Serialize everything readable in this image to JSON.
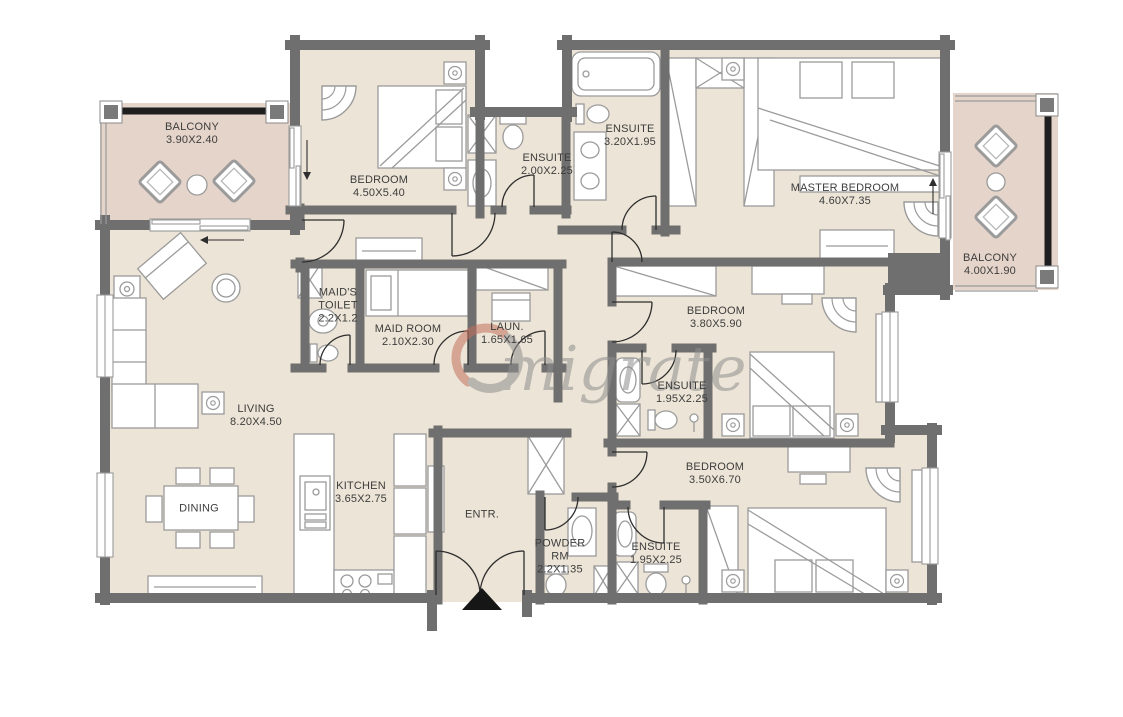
{
  "watermark": {
    "text": "migrate"
  },
  "colors": {
    "wall": "#6f6f6f",
    "floor": "#ece4d6",
    "balcony_floor": "#e5d4c9",
    "line": "#2e2e2e",
    "logo_accent": "#c4705c",
    "label_text": "#3d3d3d"
  },
  "rooms": [
    {
      "id": "balcony-left",
      "name": "BALCONY",
      "dims": "3.90X2.40"
    },
    {
      "id": "bedroom-1",
      "name": "BEDROOM",
      "dims": "4.50X5.40"
    },
    {
      "id": "ensuite-bedroom-1",
      "name": "ENSUITE",
      "dims": "2.00X2.25"
    },
    {
      "id": "ensuite-master",
      "name": "ENSUITE",
      "dims": "3.20X1.95"
    },
    {
      "id": "master-bedroom",
      "name": "MASTER BEDROOM",
      "dims": "4.60X7.35"
    },
    {
      "id": "balcony-right",
      "name": "BALCONY",
      "dims": "4.00X1.90"
    },
    {
      "id": "maids-toilet",
      "name": "MAID'S TOILET",
      "dims": "2.2X1.2"
    },
    {
      "id": "maid-room",
      "name": "MAID ROOM",
      "dims": "2.10X2.30"
    },
    {
      "id": "laundry",
      "name": "LAUN.",
      "dims": "1.65X1.65"
    },
    {
      "id": "bedroom-2",
      "name": "BEDROOM",
      "dims": "3.80X5.90"
    },
    {
      "id": "ensuite-bedroom-2",
      "name": "ENSUITE",
      "dims": "1.95X2.25"
    },
    {
      "id": "living",
      "name": "LIVING",
      "dims": "8.20X4.50"
    },
    {
      "id": "dining",
      "name": "DINING",
      "dims": ""
    },
    {
      "id": "kitchen",
      "name": "KITCHEN",
      "dims": "3.65X2.75"
    },
    {
      "id": "entrance",
      "name": "ENTR.",
      "dims": ""
    },
    {
      "id": "powder-room",
      "name": "POWDER RM",
      "dims": "2.2X1.35"
    },
    {
      "id": "ensuite-bedroom-3",
      "name": "ENSUITE",
      "dims": "1.95X2.25"
    },
    {
      "id": "bedroom-3",
      "name": "BEDROOM",
      "dims": "3.50X6.70"
    }
  ]
}
